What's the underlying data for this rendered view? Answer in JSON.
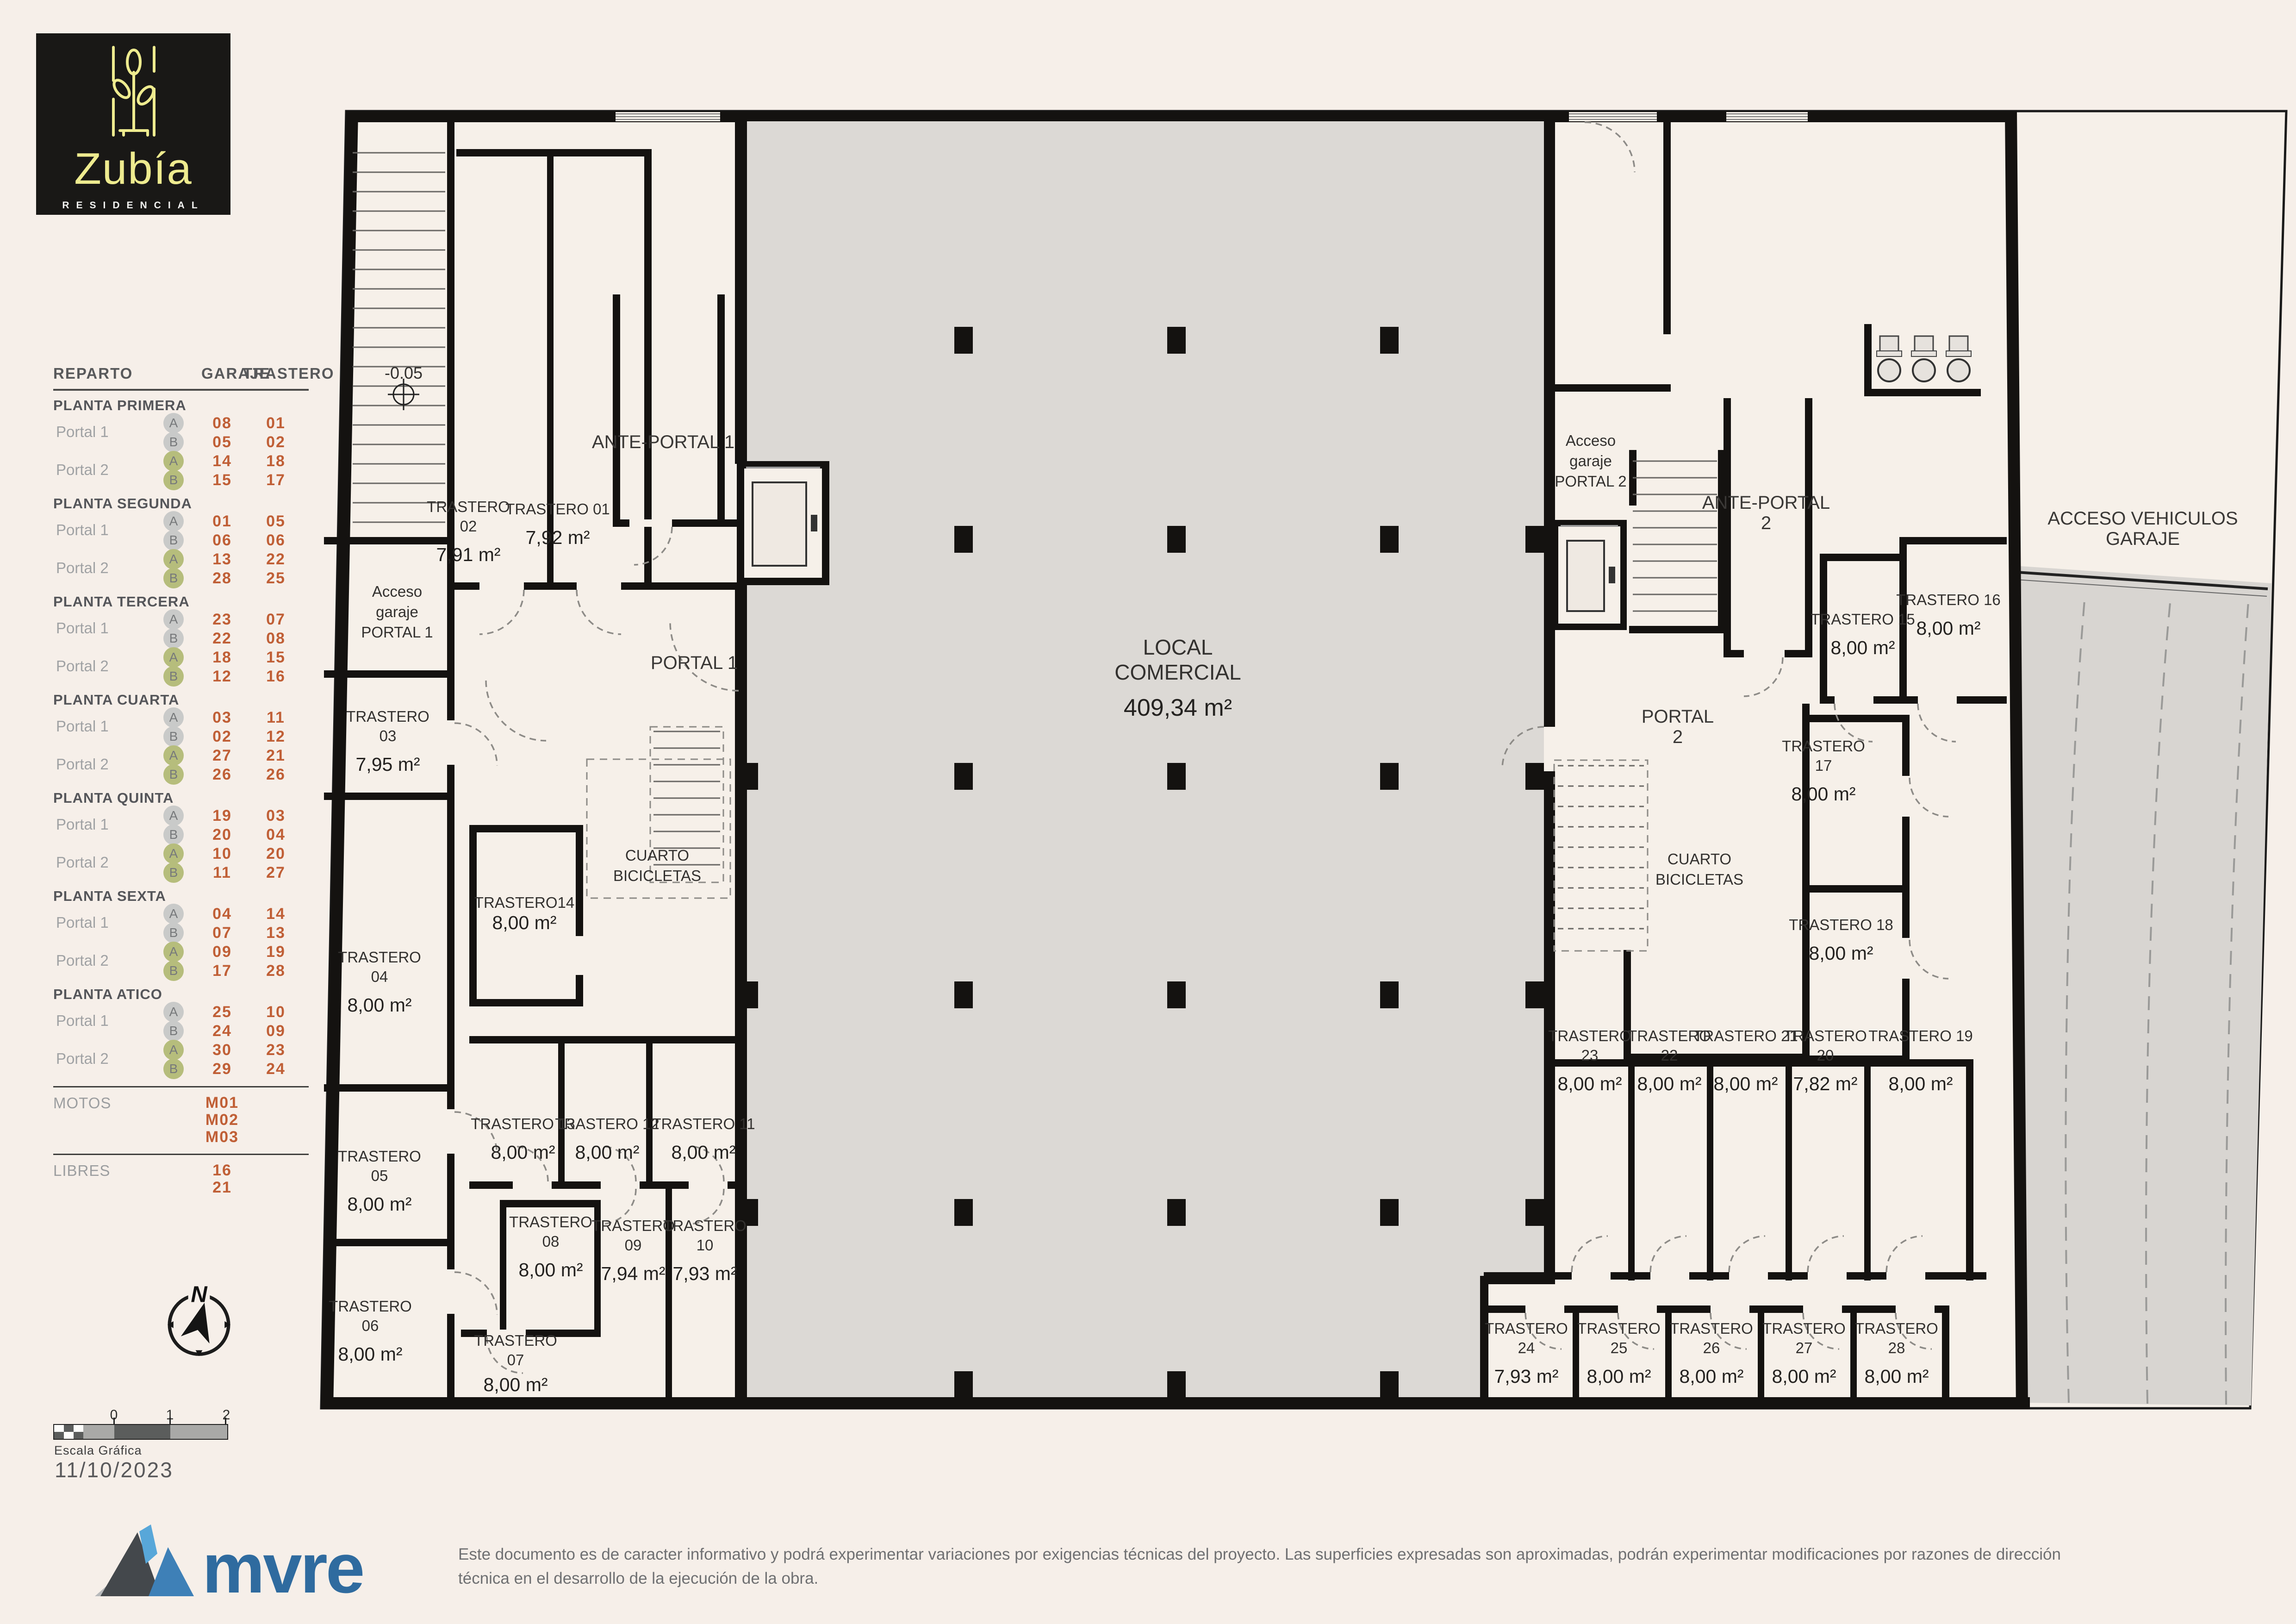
{
  "logo": {
    "name": "Zubía",
    "subtitle": "RESIDENCIAL"
  },
  "reparto": {
    "title": "REPARTO",
    "col_garaje": "GARAJE",
    "col_trastero": "TRASTERO",
    "sections": [
      {
        "name": "PLANTA PRIMERA",
        "groups": [
          {
            "portal": "Portal 1",
            "color": "gray",
            "units": [
              {
                "letter": "A",
                "garaje": "08",
                "trastero": "01"
              },
              {
                "letter": "B",
                "garaje": "05",
                "trastero": "02"
              }
            ]
          },
          {
            "portal": "Portal 2",
            "color": "green",
            "units": [
              {
                "letter": "A",
                "garaje": "14",
                "trastero": "18"
              },
              {
                "letter": "B",
                "garaje": "15",
                "trastero": "17"
              }
            ]
          }
        ]
      },
      {
        "name": "PLANTA SEGUNDA",
        "groups": [
          {
            "portal": "Portal 1",
            "color": "gray",
            "units": [
              {
                "letter": "A",
                "garaje": "01",
                "trastero": "05"
              },
              {
                "letter": "B",
                "garaje": "06",
                "trastero": "06"
              }
            ]
          },
          {
            "portal": "Portal 2",
            "color": "green",
            "units": [
              {
                "letter": "A",
                "garaje": "13",
                "trastero": "22"
              },
              {
                "letter": "B",
                "garaje": "28",
                "trastero": "25"
              }
            ]
          }
        ]
      },
      {
        "name": "PLANTA TERCERA",
        "groups": [
          {
            "portal": "Portal 1",
            "color": "gray",
            "units": [
              {
                "letter": "A",
                "garaje": "23",
                "trastero": "07"
              },
              {
                "letter": "B",
                "garaje": "22",
                "trastero": "08"
              }
            ]
          },
          {
            "portal": "Portal 2",
            "color": "green",
            "units": [
              {
                "letter": "A",
                "garaje": "18",
                "trastero": "15"
              },
              {
                "letter": "B",
                "garaje": "12",
                "trastero": "16"
              }
            ]
          }
        ]
      },
      {
        "name": "PLANTA CUARTA",
        "groups": [
          {
            "portal": "Portal 1",
            "color": "gray",
            "units": [
              {
                "letter": "A",
                "garaje": "03",
                "trastero": "11"
              },
              {
                "letter": "B",
                "garaje": "02",
                "trastero": "12"
              }
            ]
          },
          {
            "portal": "Portal 2",
            "color": "green",
            "units": [
              {
                "letter": "A",
                "garaje": "27",
                "trastero": "21"
              },
              {
                "letter": "B",
                "garaje": "26",
                "trastero": "26"
              }
            ]
          }
        ]
      },
      {
        "name": "PLANTA QUINTA",
        "groups": [
          {
            "portal": "Portal 1",
            "color": "gray",
            "units": [
              {
                "letter": "A",
                "garaje": "19",
                "trastero": "03"
              },
              {
                "letter": "B",
                "garaje": "20",
                "trastero": "04"
              }
            ]
          },
          {
            "portal": "Portal 2",
            "color": "green",
            "units": [
              {
                "letter": "A",
                "garaje": "10",
                "trastero": "20"
              },
              {
                "letter": "B",
                "garaje": "11",
                "trastero": "27"
              }
            ]
          }
        ]
      },
      {
        "name": "PLANTA SEXTA",
        "groups": [
          {
            "portal": "Portal 1",
            "color": "gray",
            "units": [
              {
                "letter": "A",
                "garaje": "04",
                "trastero": "14"
              },
              {
                "letter": "B",
                "garaje": "07",
                "trastero": "13"
              }
            ]
          },
          {
            "portal": "Portal 2",
            "color": "green",
            "units": [
              {
                "letter": "A",
                "garaje": "09",
                "trastero": "19"
              },
              {
                "letter": "B",
                "garaje": "17",
                "trastero": "28"
              }
            ]
          }
        ]
      },
      {
        "name": "PLANTA ATICO",
        "groups": [
          {
            "portal": "Portal 1",
            "color": "gray",
            "units": [
              {
                "letter": "A",
                "garaje": "25",
                "trastero": "10"
              },
              {
                "letter": "B",
                "garaje": "24",
                "trastero": "09"
              }
            ]
          },
          {
            "portal": "Portal 2",
            "color": "green",
            "units": [
              {
                "letter": "A",
                "garaje": "30",
                "trastero": "23"
              },
              {
                "letter": "B",
                "garaje": "29",
                "trastero": "24"
              }
            ]
          }
        ]
      }
    ],
    "motos": {
      "label": "MOTOS",
      "values": [
        "M01",
        "M02",
        "M03"
      ]
    },
    "libres": {
      "label": "LIBRES",
      "values": [
        "16",
        "21"
      ]
    }
  },
  "plan": {
    "compass": "N",
    "rooms": [
      {
        "lines": [
          "-0.05"
        ]
      },
      {
        "lines": [
          "TRASTERO",
          "02"
        ],
        "area": "7,91 m²"
      },
      {
        "lines": [
          "TRASTERO 01"
        ],
        "area": "7,92 m²"
      },
      {
        "lines": [
          "ANTE-PORTAL 1"
        ]
      },
      {
        "lines": [
          "Acceso",
          "garaje",
          "PORTAL 1"
        ]
      },
      {
        "lines": [
          "PORTAL 1"
        ]
      },
      {
        "lines": [
          "TRASTERO",
          "03"
        ],
        "area": "7,95 m²"
      },
      {
        "lines": [
          "TRASTERO14"
        ],
        "area": "8,00 m²"
      },
      {
        "lines": [
          "CUARTO",
          "BICICLETAS"
        ]
      },
      {
        "lines": [
          "TRASTERO",
          "04"
        ],
        "area": "8,00 m²"
      },
      {
        "lines": [
          "TRASTERO 13"
        ],
        "area": "8,00 m²"
      },
      {
        "lines": [
          "TRASTERO 12"
        ],
        "area": "8,00 m²"
      },
      {
        "lines": [
          "TRASTERO 11"
        ],
        "area": "8,00 m²"
      },
      {
        "lines": [
          "TRASTERO",
          "05"
        ],
        "area": "8,00 m²"
      },
      {
        "lines": [
          "TRASTERO",
          "08"
        ],
        "area": "8,00 m²"
      },
      {
        "lines": [
          "TRASTERO",
          "09"
        ],
        "area": "7,94 m²"
      },
      {
        "lines": [
          "TRASTERO",
          "10"
        ],
        "area": "7,93 m²"
      },
      {
        "lines": [
          "TRASTERO",
          "06"
        ],
        "area": "8,00 m²"
      },
      {
        "lines": [
          "TRASTERO",
          "07"
        ],
        "area": "8,00 m²"
      },
      {
        "lines": [
          "LOCAL",
          "COMERCIAL"
        ],
        "area": "409,34 m²"
      },
      {
        "lines": [
          "Acceso",
          "garaje",
          "PORTAL 2"
        ]
      },
      {
        "lines": [
          "ANTE-PORTAL",
          "2"
        ]
      },
      {
        "lines": [
          "PORTAL",
          "2"
        ]
      },
      {
        "lines": [
          "TRASTERO 15"
        ],
        "area": "8,00 m²"
      },
      {
        "lines": [
          "TRASTERO 16"
        ],
        "area": "8,00 m²"
      },
      {
        "lines": [
          "CUARTO",
          "BICICLETAS"
        ]
      },
      {
        "lines": [
          "TRASTERO",
          "17"
        ],
        "area": "8,00 m²"
      },
      {
        "lines": [
          "TRASTERO 18"
        ],
        "area": "8,00 m²"
      },
      {
        "lines": [
          "TRASTERO",
          "23"
        ],
        "area": "8,00 m²"
      },
      {
        "lines": [
          "TRASTERO",
          "22"
        ],
        "area": "8,00 m²"
      },
      {
        "lines": [
          "TRASTERO 21"
        ],
        "area": "8,00 m²"
      },
      {
        "lines": [
          "TRASTERO",
          "20"
        ],
        "area": "7,82 m²"
      },
      {
        "lines": [
          "TRASTERO 19"
        ],
        "area": "8,00 m²"
      },
      {
        "lines": [
          "TRASTERO",
          "24"
        ],
        "area": "7,93 m²"
      },
      {
        "lines": [
          "TRASTERO",
          "25"
        ],
        "area": "8,00 m²"
      },
      {
        "lines": [
          "TRASTERO",
          "26"
        ],
        "area": "8,00 m²"
      },
      {
        "lines": [
          "TRASTERO",
          "27"
        ],
        "area": "8,00 m²"
      },
      {
        "lines": [
          "TRASTERO",
          "28"
        ],
        "area": "8,00 m²"
      },
      {
        "lines": [
          "ACCESO VEHICULOS",
          "GARAJE"
        ]
      }
    ]
  },
  "scale_bar": {
    "labels": [
      "0",
      "1",
      "2"
    ],
    "caption": "Escala Gráfica"
  },
  "date": "11/10/2023",
  "footer": {
    "brand": "mvre",
    "disclaimer": "Este documento es de caracter informativo y podrá experimentar variaciones por exigencias técnicas del proyecto. Las superficies expresadas son aproximadas, podrán experimentar modificaciones por razones de dirección técnica en el desarrollo de la ejecución de la obra."
  },
  "colors": {
    "accent_orange": "#c05f36",
    "circle_gray": "#c9cac9",
    "circle_green": "#b6bd7c",
    "logo_yellow": "#eeeb8f",
    "brand_blue": "#2f6b9f",
    "wall_black": "#141210",
    "local_gray": "#dcd9d5"
  }
}
